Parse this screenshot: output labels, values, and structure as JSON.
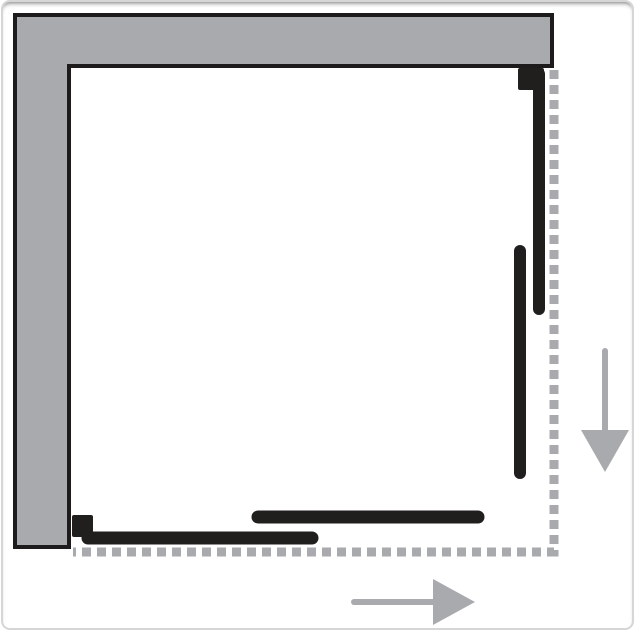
{
  "diagram": {
    "name": "shower-enclosure-corner-sliding-door-plan",
    "canvas": {
      "width": 636,
      "height": 637,
      "background": "#ffffff",
      "border_color": "#d6d6d6"
    },
    "colors": {
      "wall_fill": "#a8aaad",
      "wall_stroke": "#1d1b1b",
      "panel_black": "#211e1e",
      "dashed_gray": "#a8aaad",
      "arrow_gray": "#a8aaad"
    },
    "wall": {
      "name": "wall-l-shape",
      "points": "12,13 549,13 549,64 66,64 66,545 12,545",
      "stroke_width": 4
    },
    "dashed_outline": {
      "name": "enclosure-open-sides-dashed",
      "path": "M 551 68 V 550 H 70",
      "width": 9,
      "dash": "9 6"
    },
    "panels": [
      {
        "name": "top-right-wall-profile-block",
        "type": "rect",
        "x": 515,
        "y": 66,
        "w": 26,
        "h": 22,
        "rx": 2
      },
      {
        "name": "top-right-fixed-rail",
        "type": "line",
        "x1": 536,
        "y1": 72,
        "x2": 536,
        "y2": 307,
        "width": 12
      },
      {
        "name": "right-sliding-glass-panel",
        "type": "line",
        "x1": 517,
        "y1": 249,
        "x2": 517,
        "y2": 471,
        "width": 12
      },
      {
        "name": "bottom-sliding-glass-panel",
        "type": "line",
        "x1": 255,
        "y1": 515,
        "x2": 475,
        "y2": 515,
        "width": 13
      },
      {
        "name": "bottom-fixed-glass-panel",
        "type": "line",
        "x1": 85,
        "y1": 536,
        "x2": 309,
        "y2": 536,
        "width": 13
      },
      {
        "name": "bottom-left-wall-profile-block",
        "type": "rect",
        "x": 69,
        "y": 513,
        "w": 21,
        "h": 22,
        "rx": 2
      }
    ],
    "arrows": [
      {
        "name": "slide-direction-down-arrow",
        "shaft": {
          "x1": 602,
          "y1": 349,
          "x2": 602,
          "y2": 430,
          "width": 6
        },
        "head_points": "578,428 626,428 602,470"
      },
      {
        "name": "slide-direction-right-arrow",
        "shaft": {
          "x1": 351,
          "y1": 600,
          "x2": 430,
          "y2": 600,
          "width": 6
        },
        "head_points": "430,577 430,623 472,600"
      }
    ]
  }
}
